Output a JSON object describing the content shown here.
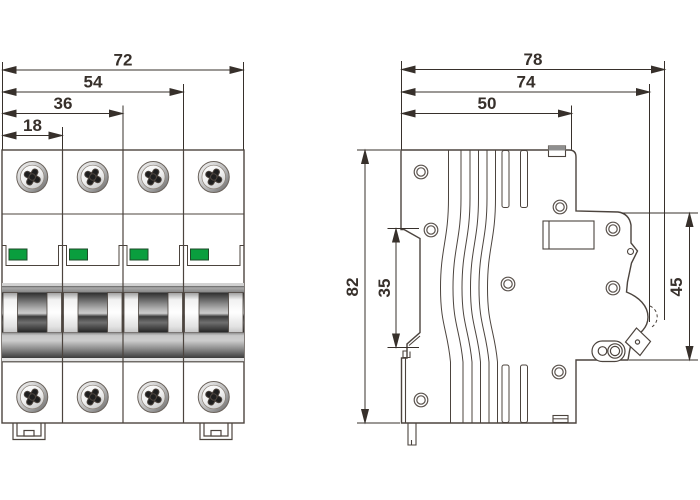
{
  "front_view": {
    "dims": {
      "d72": "72",
      "d54": "54",
      "d36": "36",
      "d18": "18"
    }
  },
  "side_view": {
    "dims": {
      "d78": "78",
      "d74": "74",
      "d50": "50",
      "d82": "82",
      "d35": "35",
      "d45": "45"
    }
  },
  "colors": {
    "outline": "#4c443e",
    "dimension": "#37302b",
    "indicator_green": "#0a9e3e"
  }
}
